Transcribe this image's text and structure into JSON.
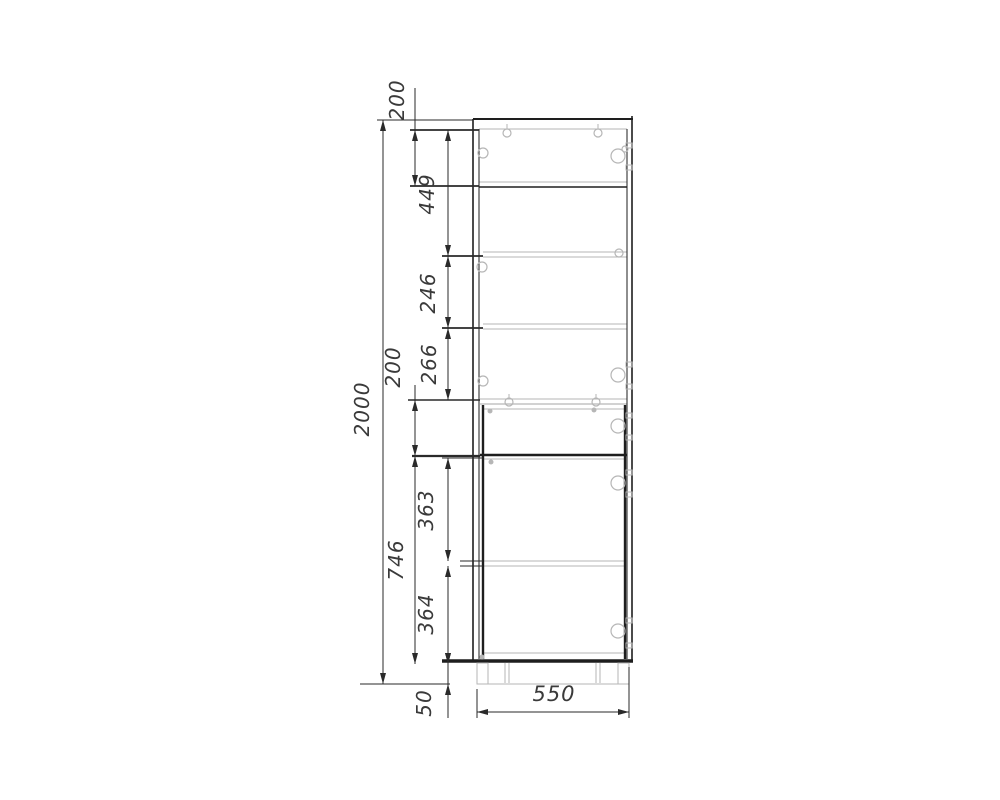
{
  "document": {
    "type": "furniture-technical-drawing",
    "subject": "tall cabinet front view with shelves, doors and plinth",
    "units": "mm"
  },
  "colors": {
    "background": "#ffffff",
    "dark": "#1e1e1e",
    "gray": "#b6b6b6",
    "dim": "#2a2a2a",
    "text": "#3a3a3a"
  },
  "dimensions": {
    "overall_height": "2000",
    "overall_width": "550",
    "plinth_height": "50",
    "vertical": [
      {
        "label": "2000",
        "x": 383,
        "y1": 120,
        "y2": 684,
        "tx": 369,
        "ty": 409
      },
      {
        "label": "200",
        "x": 415,
        "y1": 130,
        "y2": 186,
        "tx": 404,
        "ty": 100,
        "lead_top": 88
      },
      {
        "label": "449",
        "x": 448,
        "y1": 130,
        "y2": 256,
        "tx": 434,
        "ty": 194
      },
      {
        "label": "246",
        "x": 448,
        "y1": 256,
        "y2": 328,
        "tx": 435,
        "ty": 293
      },
      {
        "label": "266",
        "x": 448,
        "y1": 328,
        "y2": 400,
        "tx": 436,
        "ty": 364
      },
      {
        "label": "200",
        "x": 415,
        "y1": 400,
        "y2": 456,
        "tx": 400,
        "ty": 367,
        "lead_top": 385
      },
      {
        "label": "746",
        "x": 415,
        "y1": 456,
        "y2": 664,
        "tx": 403,
        "ty": 560
      },
      {
        "label": "363",
        "x": 448,
        "y1": 458,
        "y2": 561,
        "tx": 433,
        "ty": 510
      },
      {
        "label": "364",
        "x": 448,
        "y1": 566,
        "y2": 664,
        "tx": 433,
        "ty": 614
      },
      {
        "label": "50",
        "x": 448,
        "y1": 664,
        "y2": 684,
        "tx": 431,
        "ty": 703,
        "small": true,
        "lead_bottom": 718
      }
    ],
    "horizontal": [
      {
        "label": "550",
        "y": 712,
        "x1": 477,
        "x2": 629,
        "tx": 554,
        "ty": 701
      }
    ]
  },
  "drawing": {
    "hlines": [
      {
        "name": "top-panel-outer-line",
        "x1": 473,
        "x2": 633,
        "y": 119,
        "w": 2,
        "c": "dark"
      },
      {
        "name": "top-panel-inner-line",
        "x1": 479,
        "x2": 627,
        "y": 129,
        "w": 1,
        "c": "gray"
      },
      {
        "name": "shelf-1-top-line",
        "x1": 479,
        "x2": 627,
        "y": 182,
        "w": 1,
        "c": "gray"
      },
      {
        "name": "shelf-1-bottom-line",
        "x1": 479,
        "x2": 627,
        "y": 187,
        "w": 1.6,
        "c": "dark"
      },
      {
        "name": "shelf-2-top-line",
        "x1": 483,
        "x2": 627,
        "y": 252,
        "w": 1,
        "c": "gray"
      },
      {
        "name": "shelf-2-bottom-line",
        "x1": 483,
        "x2": 627,
        "y": 257,
        "w": 1,
        "c": "gray"
      },
      {
        "name": "shelf-3-top-line",
        "x1": 483,
        "x2": 627,
        "y": 324,
        "w": 1,
        "c": "gray"
      },
      {
        "name": "shelf-3-bottom-line",
        "x1": 483,
        "x2": 627,
        "y": 329,
        "w": 1,
        "c": "gray"
      },
      {
        "name": "divider-shelf-top-line",
        "x1": 480,
        "x2": 627,
        "y": 399,
        "w": 1,
        "c": "gray"
      },
      {
        "name": "divider-shelf-bottom-line",
        "x1": 480,
        "x2": 627,
        "y": 404,
        "w": 1.3,
        "c": "gray"
      },
      {
        "name": "door-top-line",
        "x1": 483,
        "x2": 625,
        "y": 409,
        "w": 1,
        "c": "gray"
      },
      {
        "name": "fixed-shelf-line",
        "x1": 480,
        "x2": 627,
        "y": 455,
        "w": 2.6,
        "c": "dark"
      },
      {
        "name": "fixed-shelf-inner-line",
        "x1": 483,
        "x2": 625,
        "y": 459,
        "w": 1,
        "c": "gray"
      },
      {
        "name": "shelf-4-top-line",
        "x1": 483,
        "x2": 625,
        "y": 561,
        "w": 1,
        "c": "gray"
      },
      {
        "name": "shelf-4-bottom-line",
        "x1": 483,
        "x2": 625,
        "y": 566,
        "w": 1,
        "c": "gray"
      },
      {
        "name": "bottom-panel-inner-line",
        "x1": 483,
        "x2": 625,
        "y": 653,
        "w": 1,
        "c": "gray"
      },
      {
        "name": "bottom-panel-line",
        "x1": 442,
        "x2": 633,
        "y": 661,
        "w": 3.5,
        "c": "dark"
      },
      {
        "name": "plinth-bottom-line",
        "x1": 477,
        "x2": 629,
        "y": 684,
        "w": 1,
        "c": "gray"
      }
    ],
    "vlines": [
      {
        "name": "left-side-panel-outer-line",
        "x": 473,
        "y1": 119,
        "y2": 661,
        "w": 1.6,
        "c": "dark"
      },
      {
        "name": "left-side-panel-inner-line",
        "x": 479,
        "y1": 129,
        "y2": 659,
        "w": 1,
        "c": "dark"
      },
      {
        "name": "right-side-panel-inner-line",
        "x": 627,
        "y1": 129,
        "y2": 659,
        "w": 1,
        "c": "dark"
      },
      {
        "name": "right-side-panel-outer-line",
        "x": 632,
        "y1": 116,
        "y2": 661,
        "w": 1.6,
        "c": "dark"
      },
      {
        "name": "door-left-edge-line",
        "x": 483,
        "y1": 405,
        "y2": 659,
        "w": 2.4,
        "c": "dark"
      },
      {
        "name": "door-right-edge-line",
        "x": 625,
        "y1": 405,
        "y2": 659,
        "w": 2.4,
        "c": "dark"
      },
      {
        "name": "plinth-support-line",
        "x": 505,
        "y1": 663,
        "y2": 683,
        "w": 1,
        "c": "gray"
      },
      {
        "name": "plinth-support-line",
        "x": 509,
        "y1": 663,
        "y2": 683,
        "w": 1,
        "c": "gray"
      },
      {
        "name": "plinth-support-line",
        "x": 596,
        "y1": 663,
        "y2": 683,
        "w": 1,
        "c": "gray"
      },
      {
        "name": "plinth-support-line",
        "x": 600,
        "y1": 663,
        "y2": 683,
        "w": 1,
        "c": "gray"
      },
      {
        "name": "cam-dowel-tick",
        "x": 507,
        "y1": 124,
        "y2": 129,
        "w": 1,
        "c": "gray"
      },
      {
        "name": "cam-dowel-tick",
        "x": 598,
        "y1": 124,
        "y2": 129,
        "w": 1,
        "c": "gray"
      },
      {
        "name": "cam-dowel-tick",
        "x": 509,
        "y1": 394,
        "y2": 399,
        "w": 1,
        "c": "gray"
      },
      {
        "name": "cam-dowel-tick",
        "x": 596,
        "y1": 394,
        "y2": 399,
        "w": 1,
        "c": "gray"
      }
    ],
    "rects": [
      {
        "name": "plinth-leg-left",
        "x": 477,
        "y": 663,
        "w": 11,
        "h": 21,
        "c": "gray"
      },
      {
        "name": "plinth-leg-right",
        "x": 618,
        "y": 663,
        "w": 11,
        "h": 21,
        "c": "gray"
      }
    ],
    "circles": [
      {
        "name": "shelf-pin-icon",
        "cx": 483,
        "cy": 153,
        "r": 5
      },
      {
        "name": "shelf-pin-icon",
        "cx": 482,
        "cy": 267,
        "r": 5
      },
      {
        "name": "shelf-pin-icon",
        "cx": 483,
        "cy": 381,
        "r": 5
      },
      {
        "name": "cam-fitting-icon",
        "cx": 507,
        "cy": 133,
        "r": 4
      },
      {
        "name": "cam-fitting-icon",
        "cx": 598,
        "cy": 133,
        "r": 4
      },
      {
        "name": "cam-fitting-icon",
        "cx": 509,
        "cy": 402,
        "r": 4
      },
      {
        "name": "cam-fitting-icon",
        "cx": 596,
        "cy": 402,
        "r": 4
      },
      {
        "name": "hinge-icon",
        "cx": 618,
        "cy": 156,
        "r": 7
      },
      {
        "name": "hinge-screw-icon",
        "cx": 625,
        "cy": 149,
        "r": 3
      },
      {
        "name": "shelf-pin-icon",
        "cx": 619,
        "cy": 253,
        "r": 4
      },
      {
        "name": "hinge-icon",
        "cx": 618,
        "cy": 375,
        "r": 7
      },
      {
        "name": "hinge-icon",
        "cx": 618,
        "cy": 426,
        "r": 7
      },
      {
        "name": "hinge-icon",
        "cx": 618,
        "cy": 483,
        "r": 7
      },
      {
        "name": "hinge-icon",
        "cx": 618,
        "cy": 631,
        "r": 7
      }
    ],
    "dots": [
      {
        "name": "fitting-dot",
        "cx": 490,
        "cy": 411,
        "r": 2.5
      },
      {
        "name": "fitting-dot",
        "cx": 594,
        "cy": 410,
        "r": 2.5
      },
      {
        "name": "fitting-dot",
        "cx": 491,
        "cy": 462,
        "r": 2.5
      },
      {
        "name": "fitting-dot",
        "cx": 482,
        "cy": 657,
        "r": 2.5
      }
    ],
    "pads": [
      {
        "name": "hinge-pad",
        "x": 626,
        "y": 143
      },
      {
        "name": "hinge-pad",
        "x": 626,
        "y": 165
      },
      {
        "name": "hinge-pad",
        "x": 626,
        "y": 362
      },
      {
        "name": "hinge-pad",
        "x": 626,
        "y": 384
      },
      {
        "name": "hinge-pad",
        "x": 626,
        "y": 413
      },
      {
        "name": "hinge-pad",
        "x": 626,
        "y": 435
      },
      {
        "name": "hinge-pad",
        "x": 626,
        "y": 470
      },
      {
        "name": "hinge-pad",
        "x": 626,
        "y": 492
      },
      {
        "name": "hinge-pad",
        "x": 626,
        "y": 618
      },
      {
        "name": "hinge-pad",
        "x": 626,
        "y": 643
      }
    ],
    "ext_h": [
      {
        "x1": 377,
        "x2": 473,
        "y": 120,
        "w": 1
      },
      {
        "x1": 410,
        "x2": 479,
        "y": 130,
        "w": 1.8
      },
      {
        "x1": 410,
        "x2": 479,
        "y": 186,
        "w": 1.8
      },
      {
        "x1": 442,
        "x2": 483,
        "y": 256,
        "w": 1.8
      },
      {
        "x1": 442,
        "x2": 483,
        "y": 328,
        "w": 1.8
      },
      {
        "x1": 408,
        "x2": 480,
        "y": 400,
        "w": 1.4
      },
      {
        "x1": 412,
        "x2": 480,
        "y": 456,
        "w": 2.2
      },
      {
        "x1": 442,
        "x2": 483,
        "y": 458,
        "w": 1
      },
      {
        "x1": 460,
        "x2": 483,
        "y": 561,
        "w": 1
      },
      {
        "x1": 460,
        "x2": 483,
        "y": 566,
        "w": 1
      },
      {
        "x1": 360,
        "x2": 450,
        "y": 684,
        "w": 1
      }
    ],
    "ext_v": [
      {
        "x": 477,
        "y1": 689,
        "y2": 718,
        "w": 1
      },
      {
        "x": 629,
        "y1": 667,
        "y2": 718,
        "w": 1
      }
    ]
  }
}
